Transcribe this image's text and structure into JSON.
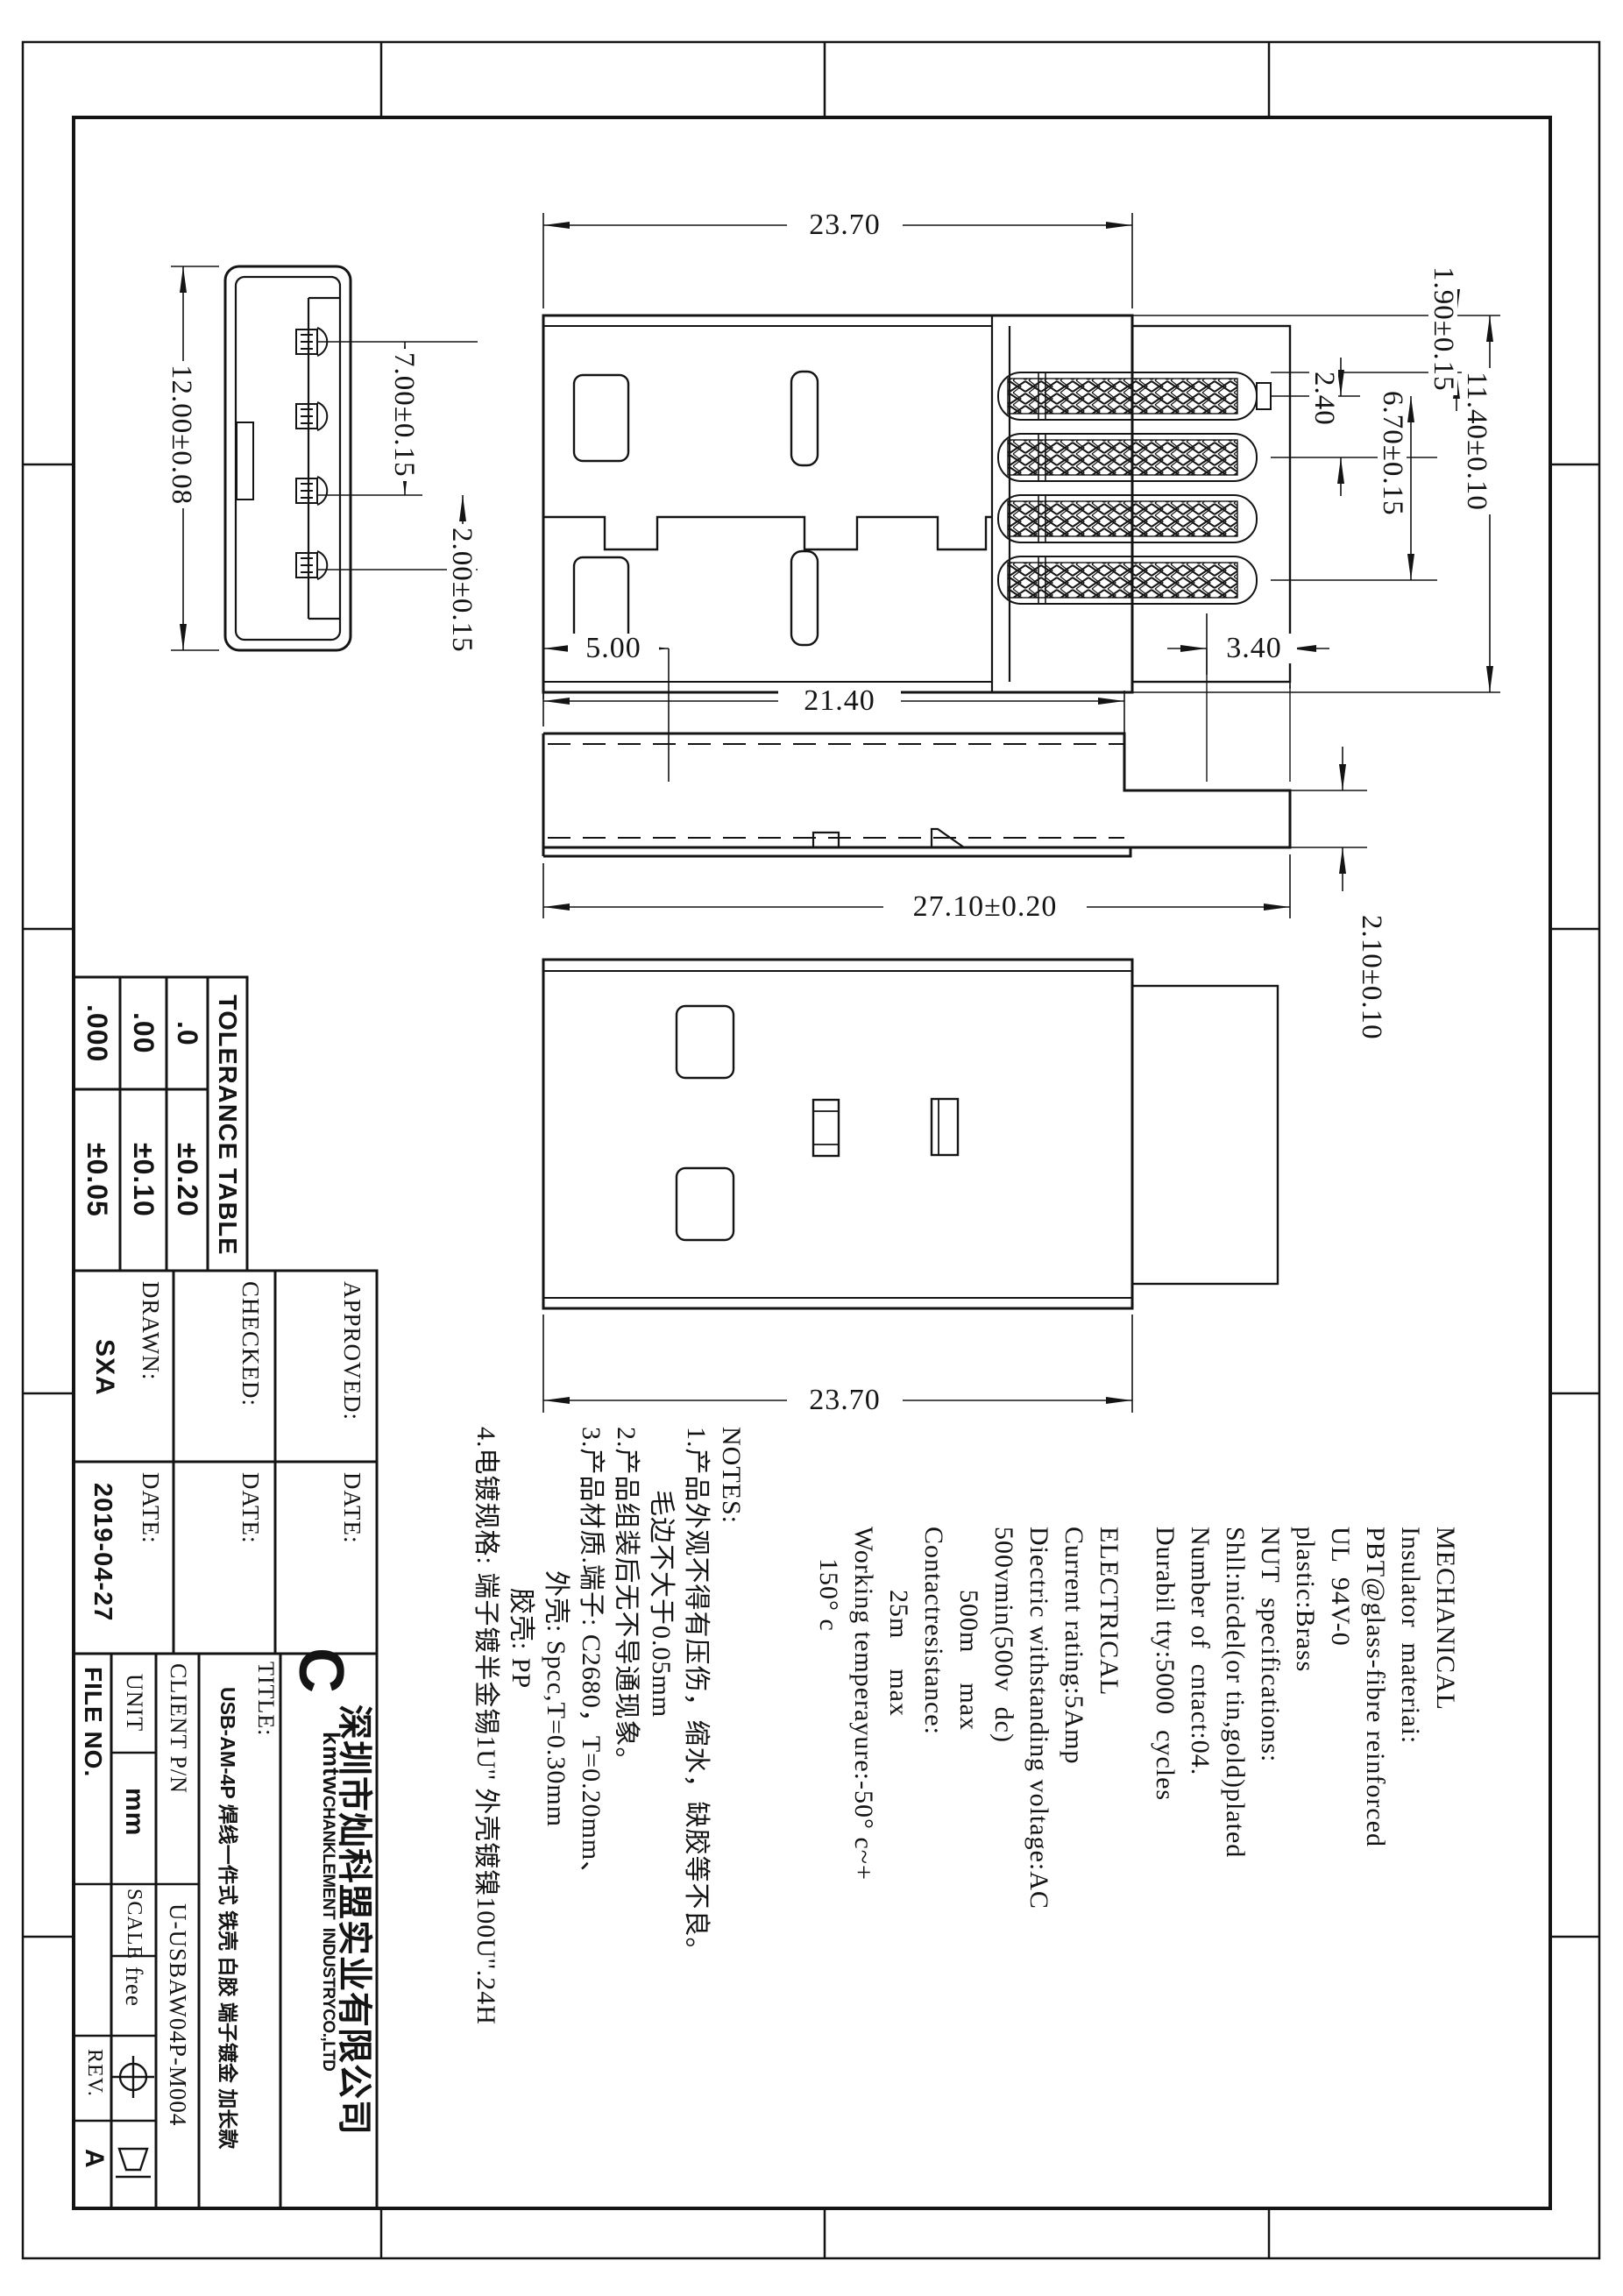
{
  "dims": {
    "top_length": "23.70",
    "hole_offset": "5.00",
    "boot_width": "3.40",
    "shell_length": "21.40",
    "total_length": "27.10±0.20",
    "bottom_length": "23.70",
    "front_height": "12.00±0.08",
    "front_pin_span": "7.00±0.15",
    "front_pin_pitch": "2.00±0.15",
    "pin_offset": "1.90±0.15",
    "top_width": "11.40±0.10",
    "pin_pitch": "2.40",
    "pin_span": "6.70±0.15",
    "boot_height": "2.10±0.10"
  },
  "tolerance_table": {
    "title": "TOLERANCE TABLE",
    "rows": [
      {
        "label": ".0",
        "value": "±0.20"
      },
      {
        "label": ".00",
        "value": "±0.10"
      },
      {
        "label": ".000",
        "value": "±0.05"
      }
    ]
  },
  "signoff": {
    "approved_label": "APPROVED:",
    "checked_label": "CHECKED:",
    "drawn_label": "DRAWN:",
    "drawn_value": "SXA",
    "date_label": "DATE:",
    "drawn_date": "2019-04-27"
  },
  "notes": {
    "lines": [
      "NOTES:",
      "1.产品外观不得有压伤，缩水，缺胶等不良。",
      "毛边不大于0.05mm",
      "2.产品组装后无不导通现象。",
      "3.产品材质.端子: C2680，T=0.20mm、",
      "外壳: Spcc,T=0.30mm",
      "胶壳: PP",
      "4.电镀规格: 端子镀半金锡1U'' 外壳镀镍100U''.24H"
    ]
  },
  "electrical": {
    "lines": [
      "ELECTRICAL",
      "Current rating:5Amp",
      "Diectric withstanding voltage:AC",
      "500vmin(500v  dc)",
      "500m    max",
      "Contactresistance:",
      "25m    max",
      "Working temperayure:-50° c~+",
      "150° c"
    ]
  },
  "mechanical": {
    "lines": [
      "MECHANICAL",
      "Insulator  materiai:",
      "PBT@glass-fibre reinforced",
      "UL  94V-0",
      "plastic:Brass",
      "NUT  specifications:",
      "Shll:nicdel(or tin,gold)plated",
      "Number of  cntact:04.",
      "Durabil tty:5000  cycles"
    ]
  },
  "title_block": {
    "file_no_label": "FILE NO.",
    "unit_label": "UNIT",
    "unit_value": "mm",
    "scale_label": "SCALE",
    "scale_value": "free",
    "rev_label": "REV.",
    "rev_value": "A",
    "client_pn_label": "CLIENT P/N",
    "client_pn_value": "U-USBAW04P-M004",
    "title_label": "TITLE:",
    "title_value": "USB-AM-4P 焊线一件式 铁壳 白胶 端子镀金 加长款",
    "company_initial": "C",
    "company_kmtw": "kmtw",
    "company_en": "CHANKLEMENT  INDUSTRYCO.,LTD",
    "company_cn": "深圳市灿科盟实业有限公司"
  }
}
